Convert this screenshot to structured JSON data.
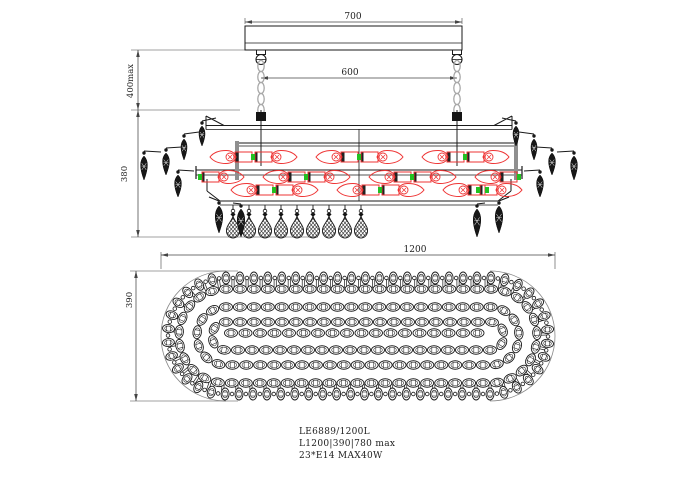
{
  "title": "Chandelier technical drawing",
  "labels": {
    "model": "LE6889/1200L",
    "size_line": "L1200|390|780 max",
    "lamp_line": "23*E14 MAX40W"
  },
  "dimensions": {
    "canopy_width": "700",
    "chain_span": "600",
    "suspension_height": "400max",
    "body_height": "380",
    "plan_length": "1200",
    "plan_width": "390"
  },
  "colors": {
    "line": "#1a1a1a",
    "dim": "#444444",
    "red": "#ee3333",
    "green": "#22c122",
    "chain": "#a8a8a8",
    "gray": "#8f8f8f"
  },
  "geometry": {
    "elevation": {
      "canopy": {
        "x1": 245,
        "x2": 462,
        "y1": 26,
        "y2": 50,
        "inner_line_y": 43
      },
      "hanger_xs": [
        261,
        457
      ],
      "chain": {
        "link_start_y": 66,
        "link_step": 11,
        "link_count": 5
      },
      "rod": {
        "y1": 110,
        "y2": 166
      },
      "dim700": {
        "y": 22,
        "x1": 245,
        "x2": 462,
        "ext_top": 18
      },
      "dim600": {
        "y": 78,
        "x1": 261,
        "x2": 457
      },
      "dim400": {
        "x": 138,
        "y1": 50,
        "y2": 110,
        "ext_top": {
          "y": 50,
          "x1": 131,
          "x2": 245
        },
        "ext_bot": {
          "y": 110,
          "x1": 131,
          "x2": 240
        }
      },
      "dim380": {
        "x": 138,
        "y1": 110,
        "y2": 237,
        "ext_bot": {
          "y": 237,
          "x1": 131,
          "x2": 318
        }
      },
      "frame": {
        "top_rail": {
          "x1": 206,
          "x2": 512,
          "y1": 125.5,
          "y2": 129.5,
          "peak_y": 116,
          "chamfer_dx": 18
        },
        "rail_b": {
          "x1": 239,
          "x2": 517,
          "y1": 143,
          "y2": 146
        },
        "mid_rail": {
          "x1": 196,
          "x2": 522,
          "y1": 170,
          "y2": 175,
          "cap_y1": 166,
          "cap_y2": 179
        },
        "bot_rail": {
          "x1": 220,
          "x2": 498,
          "y1": 201,
          "y2": 205,
          "post_y1": 179,
          "post_y2": 191,
          "post_x_l": 207,
          "post_x_r": 511
        },
        "gray_posts": [
          {
            "x": 237,
            "y1": 141,
            "y2": 180
          },
          {
            "x": 516,
            "y1": 141,
            "y2": 180
          }
        ],
        "center_post": {
          "x": 359,
          "y1": 129,
          "y2": 201
        }
      },
      "lamp_rows": [
        {
          "cy": 157,
          "xs": [
            227,
            280,
            333,
            386,
            439,
            492
          ],
          "dirs": [
            -1,
            1,
            -1,
            1,
            -1,
            1
          ]
        },
        {
          "cy": 177,
          "xs": [
            227,
            280,
            333,
            386,
            439,
            492
          ],
          "dirs": [
            1,
            -1,
            1,
            -1,
            1,
            -1
          ]
        },
        {
          "cy": 190,
          "xs": [
            248,
            301,
            354,
            407,
            460,
            505
          ],
          "dirs": [
            -1,
            1,
            -1,
            1,
            -1,
            1
          ]
        }
      ],
      "lamp": {
        "bulb_len": 26,
        "bulb_h": 13,
        "socket_w": 16,
        "socket_h": 10,
        "cap_r": 4
      },
      "side_drops": [
        {
          "x": 202,
          "y": 126,
          "len": 20,
          "w": 8,
          "ax": 216,
          "ay": 118
        },
        {
          "x": 184,
          "y": 139,
          "len": 21,
          "w": 8,
          "ax": 199,
          "ay": 132
        },
        {
          "x": 166,
          "y": 153,
          "len": 22,
          "w": 9,
          "ax": 182,
          "ay": 147
        },
        {
          "x": 144,
          "y": 156,
          "len": 24,
          "w": 9,
          "ax": 161,
          "ay": 152
        },
        {
          "x": 178,
          "y": 175,
          "len": 22,
          "w": 9,
          "ax": 194,
          "ay": 171
        },
        {
          "x": 219,
          "y": 206,
          "len": 27,
          "w": 10,
          "ax": 209,
          "ay": 197
        },
        {
          "x": 241,
          "y": 209,
          "len": 28,
          "w": 10,
          "ax": 233,
          "ay": 203
        },
        {
          "x": 516,
          "y": 126,
          "len": 20,
          "w": 8,
          "ax": 502,
          "ay": 118
        },
        {
          "x": 534,
          "y": 139,
          "len": 21,
          "w": 8,
          "ax": 519,
          "ay": 132
        },
        {
          "x": 552,
          "y": 153,
          "len": 22,
          "w": 9,
          "ax": 536,
          "ay": 147
        },
        {
          "x": 574,
          "y": 156,
          "len": 24,
          "w": 9,
          "ax": 557,
          "ay": 152
        },
        {
          "x": 540,
          "y": 175,
          "len": 22,
          "w": 9,
          "ax": 524,
          "ay": 171
        },
        {
          "x": 499,
          "y": 206,
          "len": 27,
          "w": 10,
          "ax": 509,
          "ay": 197
        },
        {
          "x": 477,
          "y": 209,
          "len": 28,
          "w": 10,
          "ax": 485,
          "ay": 203
        }
      ],
      "teardrops": {
        "xs": [
          233,
          249,
          265,
          281,
          297,
          313,
          329,
          345,
          361
        ],
        "rail_y": 205,
        "top_y": 216,
        "len": 22,
        "w": 13
      }
    },
    "plan": {
      "cap_cx1": 226,
      "cap_cx2": 490,
      "cy": 336,
      "outline_r": 65,
      "radial_ring": {
        "r": 58,
        "spacing": 14,
        "bead_len": 12,
        "bead_w": 8,
        "link_r": 1.8
      },
      "rung_ring": {
        "r": 52.5,
        "spacing": 14,
        "half_len": 4.5
      },
      "chain_rings": [
        47,
        29,
        14
      ],
      "chain_bead": {
        "len": 13,
        "w": 8.5,
        "spacing": 14
      },
      "center_row": {
        "y": 333,
        "x1": 231,
        "x2": 485,
        "spacing": 14.5
      },
      "dim1200": {
        "y": 255,
        "x1": 161,
        "x2": 555,
        "ext_y2": 269
      },
      "dim390": {
        "x": 136,
        "y1": 271,
        "y2": 401,
        "ext_x1": 130,
        "ext_x2": 238
      }
    },
    "notes_pos": {
      "x": 299,
      "ys": [
        434,
        446,
        458
      ]
    }
  }
}
